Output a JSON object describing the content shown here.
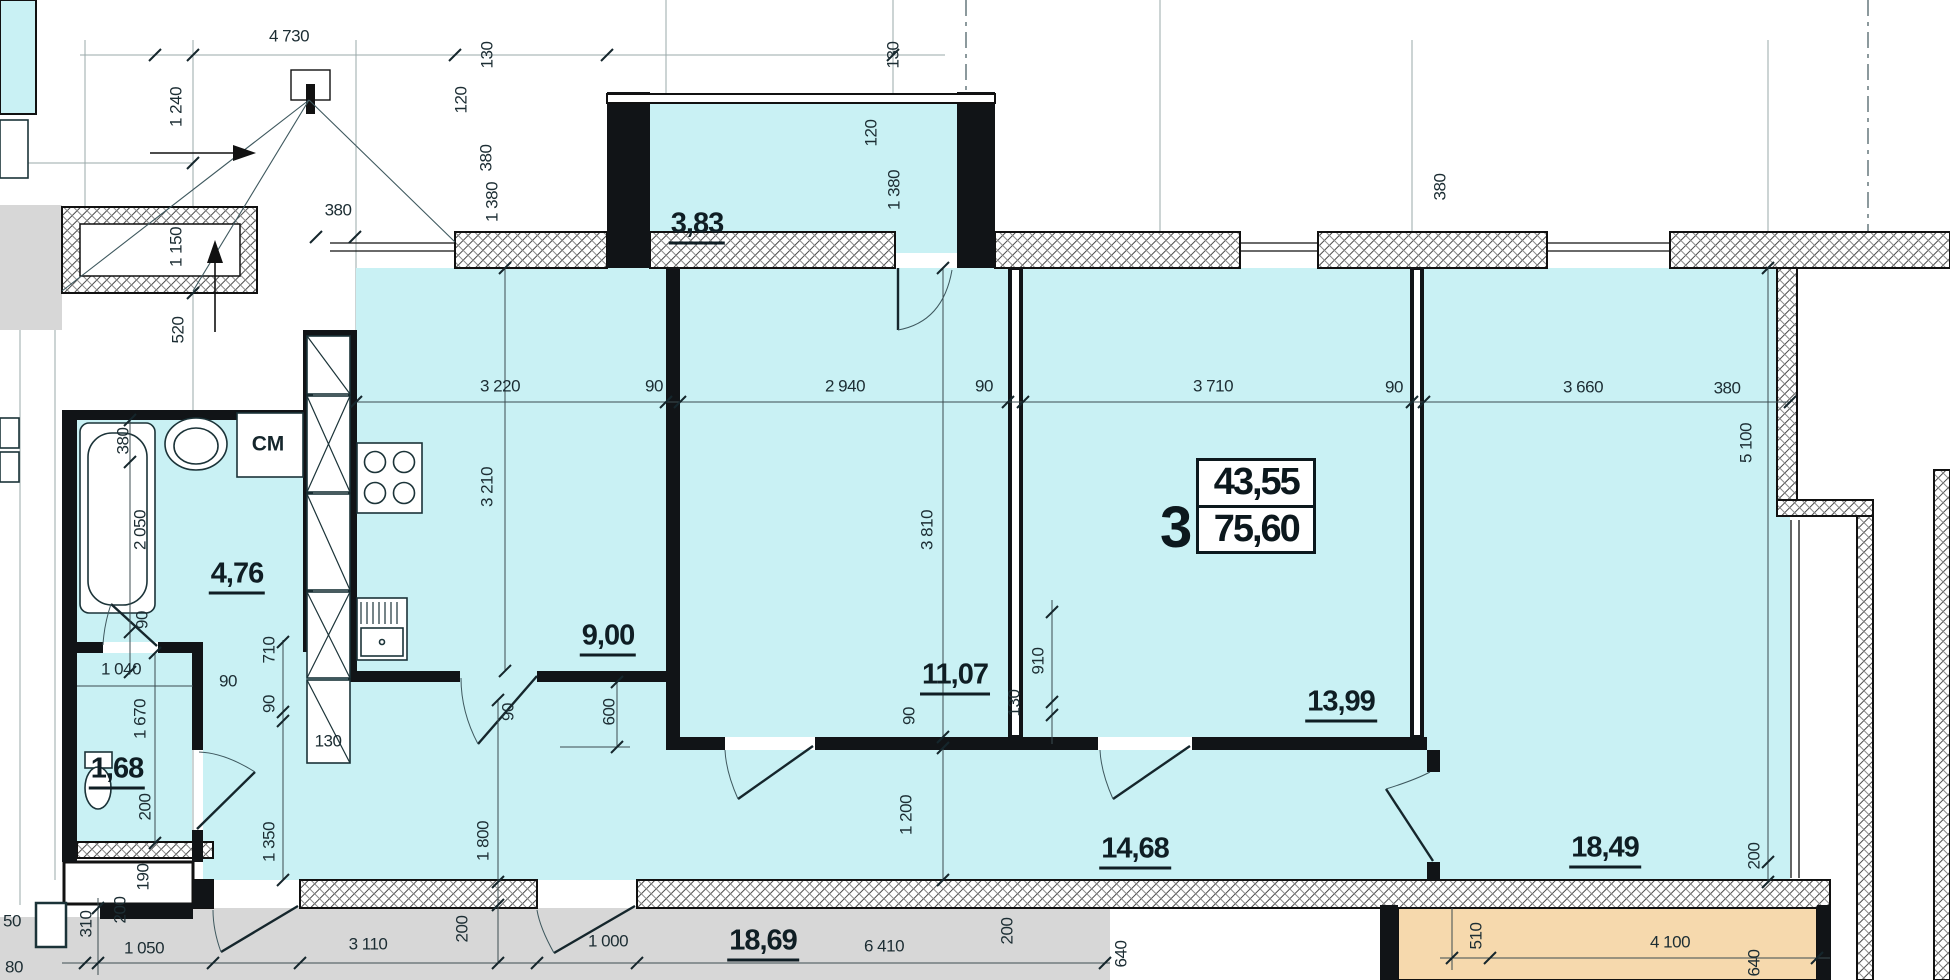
{
  "title": "Apartment floor plan, flat 3",
  "badge": {
    "number": "3",
    "area_upper": "43,55",
    "area_lower": "75,60"
  },
  "fixtures": [
    {
      "label": "СМ",
      "x": 268,
      "y": 444
    }
  ],
  "rooms": [
    {
      "label": "3,83",
      "x": 697,
      "y": 227
    },
    {
      "label": "4,76",
      "x": 237,
      "y": 577
    },
    {
      "label": "1,68",
      "x": 117,
      "y": 772
    },
    {
      "label": "9,00",
      "x": 608,
      "y": 639
    },
    {
      "label": "11,07",
      "x": 955,
      "y": 678
    },
    {
      "label": "13,99",
      "x": 1341,
      "y": 705
    },
    {
      "label": "14,68",
      "x": 1135,
      "y": 852
    },
    {
      "label": "18,49",
      "x": 1605,
      "y": 851
    },
    {
      "label": "18,69",
      "x": 763,
      "y": 944
    }
  ],
  "dimensions": [
    {
      "t": "4 730",
      "x": 289,
      "y": 36
    },
    {
      "t": "1 240",
      "x": 176,
      "y": 107,
      "v": true
    },
    {
      "t": "1 150",
      "x": 176,
      "y": 247,
      "v": true
    },
    {
      "t": "380",
      "x": 338,
      "y": 210
    },
    {
      "t": "520",
      "x": 178,
      "y": 330,
      "v": true
    },
    {
      "t": "130",
      "x": 487,
      "y": 55,
      "v": true
    },
    {
      "t": "120",
      "x": 461,
      "y": 100,
      "v": true
    },
    {
      "t": "380",
      "x": 486,
      "y": 158,
      "v": true
    },
    {
      "t": "1 380",
      "x": 492,
      "y": 202,
      "v": true
    },
    {
      "t": "130",
      "x": 893,
      "y": 55,
      "v": true
    },
    {
      "t": "120",
      "x": 871,
      "y": 133,
      "v": true
    },
    {
      "t": "1 380",
      "x": 894,
      "y": 190,
      "v": true
    },
    {
      "t": "380",
      "x": 1440,
      "y": 187,
      "v": true
    },
    {
      "t": "3 220",
      "x": 500,
      "y": 386
    },
    {
      "t": "90",
      "x": 654,
      "y": 386
    },
    {
      "t": "2 940",
      "x": 845,
      "y": 386
    },
    {
      "t": "90",
      "x": 984,
      "y": 386
    },
    {
      "t": "3 710",
      "x": 1213,
      "y": 386
    },
    {
      "t": "90",
      "x": 1394,
      "y": 387
    },
    {
      "t": "3 660",
      "x": 1583,
      "y": 387
    },
    {
      "t": "380",
      "x": 1727,
      "y": 388
    },
    {
      "t": "3 210",
      "x": 487,
      "y": 487,
      "v": true
    },
    {
      "t": "3 810",
      "x": 927,
      "y": 530,
      "v": true
    },
    {
      "t": "5 100",
      "x": 1746,
      "y": 443,
      "v": true
    },
    {
      "t": "380",
      "x": 123,
      "y": 441,
      "v": true
    },
    {
      "t": "2 050",
      "x": 140,
      "y": 530,
      "v": true
    },
    {
      "t": "90",
      "x": 142,
      "y": 620,
      "v": true
    },
    {
      "t": "1 040",
      "x": 121,
      "y": 669
    },
    {
      "t": "1 670",
      "x": 140,
      "y": 719,
      "v": true
    },
    {
      "t": "90",
      "x": 228,
      "y": 681
    },
    {
      "t": "710",
      "x": 269,
      "y": 650,
      "v": true
    },
    {
      "t": "90",
      "x": 269,
      "y": 704,
      "v": true
    },
    {
      "t": "130",
      "x": 328,
      "y": 741
    },
    {
      "t": "200",
      "x": 145,
      "y": 807,
      "v": true
    },
    {
      "t": "1 350",
      "x": 269,
      "y": 842,
      "v": true
    },
    {
      "t": "90",
      "x": 508,
      "y": 712,
      "v": true
    },
    {
      "t": "600",
      "x": 609,
      "y": 712,
      "v": true
    },
    {
      "t": "90",
      "x": 909,
      "y": 716,
      "v": true
    },
    {
      "t": "1 200",
      "x": 906,
      "y": 815,
      "v": true
    },
    {
      "t": "910",
      "x": 1038,
      "y": 661,
      "v": true
    },
    {
      "t": "130",
      "x": 1014,
      "y": 703,
      "v": true
    },
    {
      "t": "200",
      "x": 1754,
      "y": 856,
      "v": true
    },
    {
      "t": "1 800",
      "x": 483,
      "y": 841,
      "v": true
    },
    {
      "t": "190",
      "x": 143,
      "y": 877,
      "v": true
    },
    {
      "t": "200",
      "x": 120,
      "y": 910,
      "v": true
    },
    {
      "t": "310",
      "x": 86,
      "y": 924,
      "v": true
    },
    {
      "t": "50",
      "x": 12,
      "y": 921
    },
    {
      "t": "80",
      "x": 14,
      "y": 967
    },
    {
      "t": "1 050",
      "x": 144,
      "y": 948
    },
    {
      "t": "3 110",
      "x": 368,
      "y": 944
    },
    {
      "t": "200",
      "x": 462,
      "y": 929,
      "v": true
    },
    {
      "t": "1 000",
      "x": 608,
      "y": 941
    },
    {
      "t": "6 410",
      "x": 884,
      "y": 946
    },
    {
      "t": "200",
      "x": 1007,
      "y": 931,
      "v": true
    },
    {
      "t": "640",
      "x": 1121,
      "y": 954,
      "v": true
    },
    {
      "t": "510",
      "x": 1476,
      "y": 936,
      "v": true
    },
    {
      "t": "4 100",
      "x": 1670,
      "y": 942
    },
    {
      "t": "640",
      "x": 1754,
      "y": 963,
      "v": true
    }
  ],
  "colors": {
    "room_fill": "#c9f1f4",
    "terrace_fill": "#d7d7d7",
    "loggia_fill": "#f6d9ad",
    "wall": "#111417",
    "dim_line": "#3c4c50"
  }
}
